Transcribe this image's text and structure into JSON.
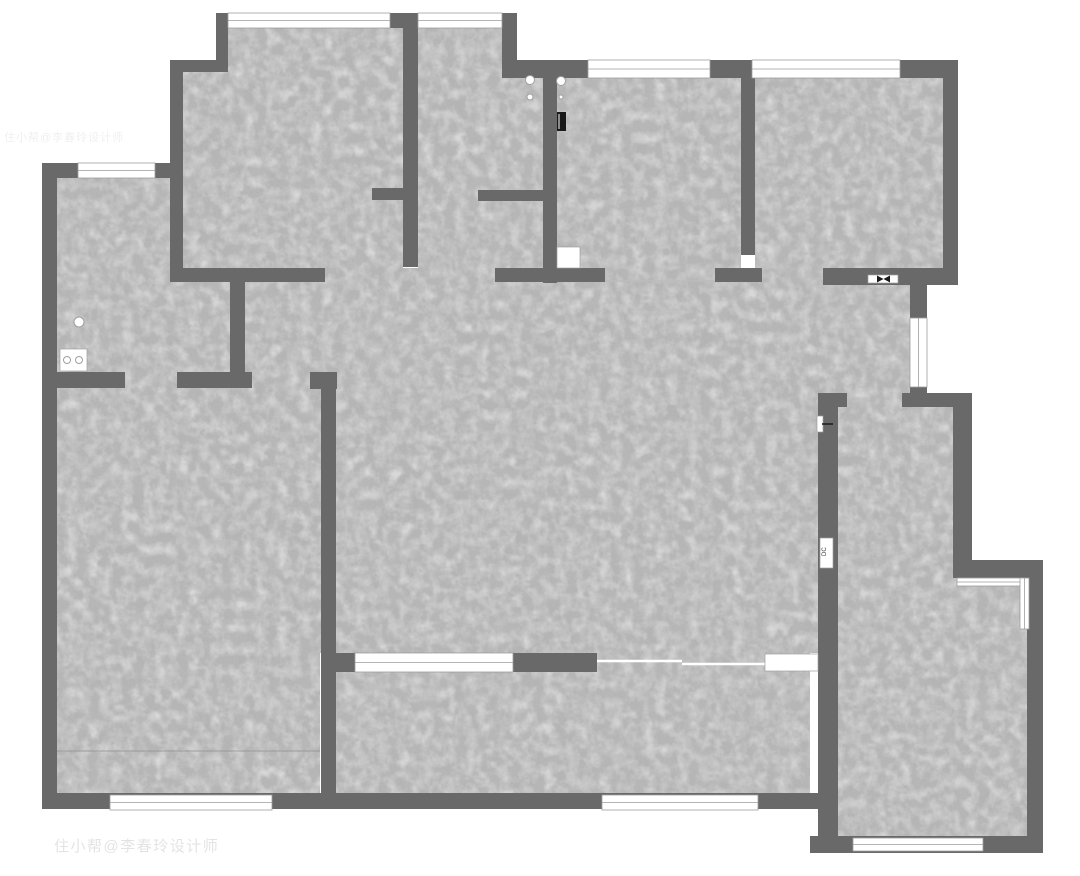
{
  "canvas": {
    "width": 1080,
    "height": 876
  },
  "colors": {
    "background": "#ffffff",
    "wall": "#696969",
    "floor_base": "#b2b2b2",
    "window_fill": "#ffffff",
    "window_line": "#9d9d9d",
    "threshold_line": "#bcbcbc",
    "slide_line": "#ffffff",
    "floor_seam_line": "#8f8f8f",
    "fixture_stroke": "#a0a0a0",
    "mark_dark": "#1a1a1a",
    "watermark": "#c9c9c9"
  },
  "floors": [
    [
      228,
      28,
      175,
      44
    ],
    [
      183,
      72,
      220,
      210
    ],
    [
      418,
      28,
      84,
      50
    ],
    [
      418,
      72,
      125,
      210
    ],
    [
      557,
      78,
      184,
      204
    ],
    [
      755,
      78,
      188,
      190
    ],
    [
      245,
      268,
      585,
      385
    ],
    [
      810,
      283,
      102,
      110
    ],
    [
      838,
      393,
      74,
      14
    ],
    [
      57,
      178,
      173,
      212
    ],
    [
      57,
      372,
      263,
      425
    ],
    [
      335,
      653,
      475,
      142
    ],
    [
      830,
      405,
      123,
      175
    ],
    [
      830,
      562,
      197,
      274
    ]
  ],
  "walls": [
    [
      216,
      13,
      12,
      59
    ],
    [
      390,
      13,
      13,
      15
    ],
    [
      170,
      60,
      58,
      12
    ],
    [
      170,
      60,
      13,
      220
    ],
    [
      403,
      13,
      15,
      254
    ],
    [
      502,
      13,
      15,
      65
    ],
    [
      502,
      60,
      86,
      18
    ],
    [
      710,
      60,
      42,
      18
    ],
    [
      900,
      60,
      58,
      18
    ],
    [
      943,
      60,
      15,
      223
    ],
    [
      823,
      268,
      135,
      17
    ],
    [
      910,
      283,
      17,
      124
    ],
    [
      902,
      393,
      70,
      14
    ],
    [
      953,
      405,
      19,
      173
    ],
    [
      953,
      560,
      90,
      18
    ],
    [
      1027,
      560,
      16,
      293
    ],
    [
      810,
      836,
      233,
      17
    ],
    [
      818,
      393,
      29,
      14
    ],
    [
      818,
      395,
      20,
      458
    ],
    [
      42,
      793,
      776,
      16
    ],
    [
      42,
      163,
      15,
      646
    ],
    [
      42,
      163,
      130,
      15
    ],
    [
      170,
      268,
      155,
      14
    ],
    [
      372,
      188,
      31,
      12
    ],
    [
      478,
      190,
      65,
      11
    ],
    [
      543,
      72,
      14,
      211
    ],
    [
      495,
      268,
      110,
      14
    ],
    [
      741,
      78,
      14,
      177
    ],
    [
      715,
      268,
      47,
      14
    ],
    [
      230,
      280,
      15,
      92
    ],
    [
      42,
      372,
      83,
      16
    ],
    [
      177,
      372,
      75,
      16
    ],
    [
      310,
      372,
      27,
      17
    ],
    [
      321,
      388,
      15,
      406
    ],
    [
      335,
      653,
      20,
      19
    ],
    [
      513,
      653,
      84,
      19
    ]
  ],
  "windows": [
    [
      228,
      13,
      162,
      15
    ],
    [
      418,
      13,
      84,
      15
    ],
    [
      588,
      60,
      122,
      18
    ],
    [
      752,
      60,
      148,
      18
    ],
    [
      78,
      163,
      77,
      15
    ],
    [
      910,
      318,
      17,
      69
    ],
    [
      957,
      578,
      68,
      8
    ],
    [
      1020,
      578,
      9,
      51
    ],
    [
      853,
      838,
      130,
      13
    ],
    [
      110,
      795,
      162,
      15
    ],
    [
      602,
      795,
      156,
      15
    ],
    [
      355,
      653,
      158,
      19
    ]
  ],
  "white_boxes": [
    {
      "x": 557,
      "y": 247,
      "w": 23,
      "h": 21
    },
    {
      "x": 765,
      "y": 654,
      "w": 53,
      "h": 17
    },
    {
      "x": 868,
      "y": 275,
      "w": 30,
      "h": 8
    },
    {
      "x": 60,
      "y": 349,
      "w": 27,
      "h": 22
    },
    {
      "x": 817,
      "y": 416,
      "w": 6,
      "h": 16
    },
    {
      "x": 820,
      "y": 538,
      "w": 13,
      "h": 30
    }
  ],
  "circles": [
    {
      "cx": 530,
      "cy": 80,
      "r": 4.5,
      "filled": true
    },
    {
      "cx": 530,
      "cy": 97,
      "r": 3,
      "filled": true
    },
    {
      "cx": 561,
      "cy": 81,
      "r": 4.5,
      "filled": true
    },
    {
      "cx": 561,
      "cy": 97,
      "r": 2,
      "filled": true
    },
    {
      "cx": 79,
      "cy": 322,
      "r": 5,
      "filled": true
    },
    {
      "cx": 67,
      "cy": 360,
      "r": 3.5,
      "filled": false
    },
    {
      "cx": 79,
      "cy": 360,
      "r": 3.5,
      "filled": false
    }
  ],
  "dark_marks": {
    "meter_bar": {
      "x": 557,
      "y": 112,
      "w": 9,
      "h": 19
    },
    "valve": {
      "cx": 883.5,
      "cy": 279,
      "half_w": 6.5,
      "half_h": 3.5
    },
    "hinge_tick": {
      "x1": 822,
      "y1": 424,
      "x2": 833,
      "y2": 424
    }
  },
  "lines": [
    {
      "x1": 605,
      "y1": 281,
      "x2": 714,
      "y2": 281,
      "color_key": "threshold_line",
      "w": 1.5
    },
    {
      "x1": 597,
      "y1": 661,
      "x2": 682,
      "y2": 661,
      "color_key": "slide_line",
      "w": 2.5
    },
    {
      "x1": 682,
      "y1": 664,
      "x2": 765,
      "y2": 664,
      "color_key": "slide_line",
      "w": 2.5
    },
    {
      "x1": 57,
      "y1": 751,
      "x2": 320,
      "y2": 751,
      "color_key": "floor_seam_line",
      "w": 0.8
    }
  ],
  "labels": [
    {
      "text": "DC",
      "x": 826,
      "y": 556,
      "rotate": -90,
      "size": 6,
      "color": "#333333"
    }
  ],
  "watermarks": [
    {
      "text": "住小帮@李春玲设计师",
      "x": 54,
      "y": 851,
      "size": 15,
      "opacity": 0.5,
      "letter_spacing": 1.5
    },
    {
      "text": "住小帮@李春玲设计师",
      "x": 4,
      "y": 141,
      "size": 11,
      "opacity": 0.28,
      "letter_spacing": 1
    }
  ]
}
